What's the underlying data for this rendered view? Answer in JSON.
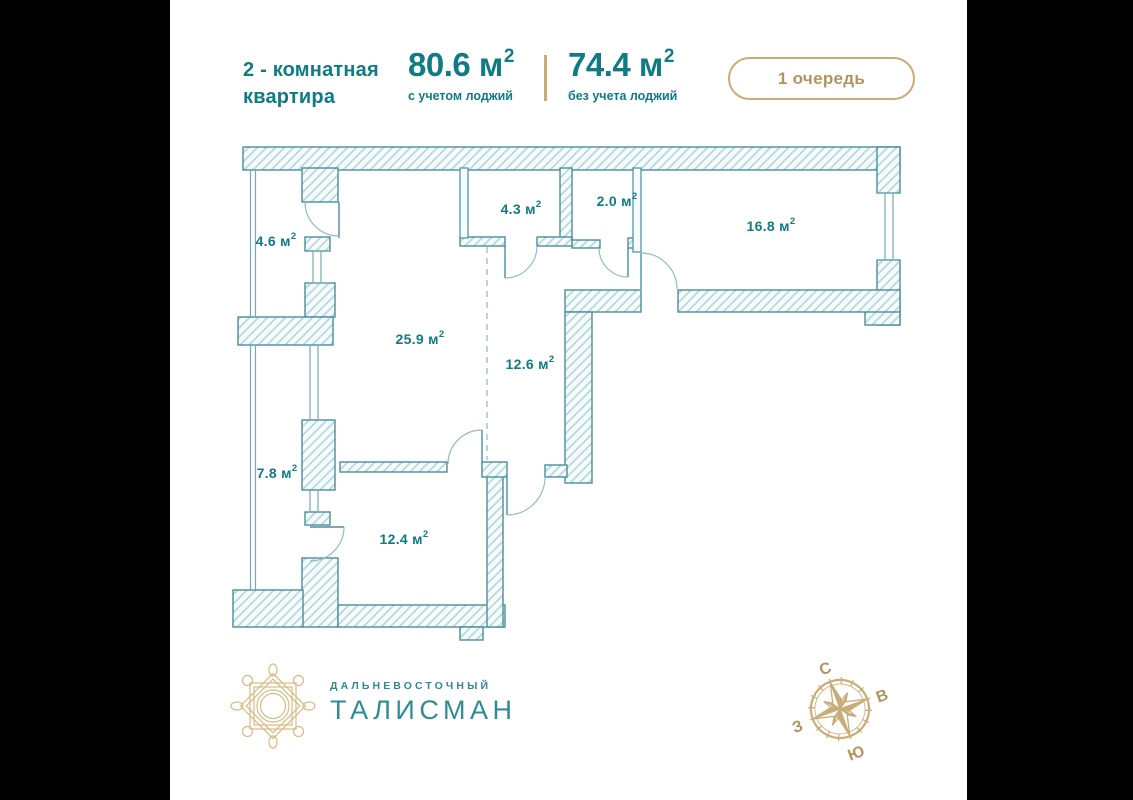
{
  "page": {
    "background": "#000000",
    "card_background": "#ffffff"
  },
  "header": {
    "apartment_type_line1": "2 - комнатная",
    "apartment_type_line2": "квартира",
    "area_with": {
      "value": "80.6",
      "unit": "м",
      "exponent": "2",
      "label": "с учетом лоджий"
    },
    "area_without": {
      "value": "74.4",
      "unit": "м",
      "exponent": "2",
      "label": "без учета лоджий"
    },
    "phase_badge": "1 очередь"
  },
  "floor_plan": {
    "unit": {
      "base": "м",
      "exponent": "2"
    },
    "rooms": [
      {
        "id": "loggia-top",
        "value": "4.6",
        "x": 276,
        "y": 242
      },
      {
        "id": "room-4-3",
        "value": "4.3",
        "x": 521,
        "y": 210
      },
      {
        "id": "room-2-0",
        "value": "2.0",
        "x": 617,
        "y": 202
      },
      {
        "id": "bedroom",
        "value": "16.8",
        "x": 771,
        "y": 227
      },
      {
        "id": "living-kitchen",
        "value": "25.9",
        "x": 420,
        "y": 340
      },
      {
        "id": "hallway",
        "value": "12.6",
        "x": 530,
        "y": 365
      },
      {
        "id": "loggia-bottom",
        "value": "7.8",
        "x": 277,
        "y": 474
      },
      {
        "id": "room-12-4",
        "value": "12.4",
        "x": 404,
        "y": 540
      }
    ]
  },
  "footer": {
    "brand_line1": "ДАЛЬНЕВОСТОЧНЫЙ",
    "brand_line2": "ТАЛИСМАН",
    "compass": {
      "north": "С",
      "east": "В",
      "south": "Ю",
      "west": "З"
    }
  },
  "colors": {
    "teal_text": "#0f7b83",
    "wall_stroke": "#4a8f9b",
    "hatch_line": "#b8d8de",
    "thin_line": "#74aab5",
    "gold_border": "#c9ad79",
    "gold_text": "#b3945c",
    "logo_gold": "#d8bb84",
    "brand_teal": "#2f8d92"
  }
}
